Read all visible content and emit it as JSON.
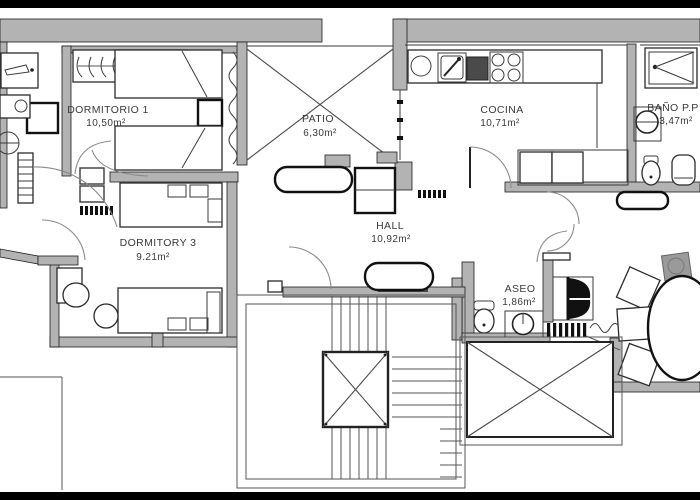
{
  "plan": {
    "type": "apartment-floor-plan",
    "rooms": [
      {
        "name": "DORMITORIO 1",
        "area": "10,50m²"
      },
      {
        "name": "PATIO",
        "area": "6,30m²"
      },
      {
        "name": "COCINA",
        "area": "10,71m²"
      },
      {
        "name": "BAÑO P.P",
        "area": "3,47m²"
      },
      {
        "name": "HALL",
        "area": "10,92m²"
      },
      {
        "name": "DORMITORY 3",
        "area": "9.21m²"
      },
      {
        "name": "ASEO",
        "area": "1,86m²"
      }
    ],
    "colors": {
      "wall": "#b3b3b3",
      "line": "#2b2b2b",
      "frame": "#000000",
      "background": "#ffffff",
      "text": "#3a3a3a"
    }
  }
}
